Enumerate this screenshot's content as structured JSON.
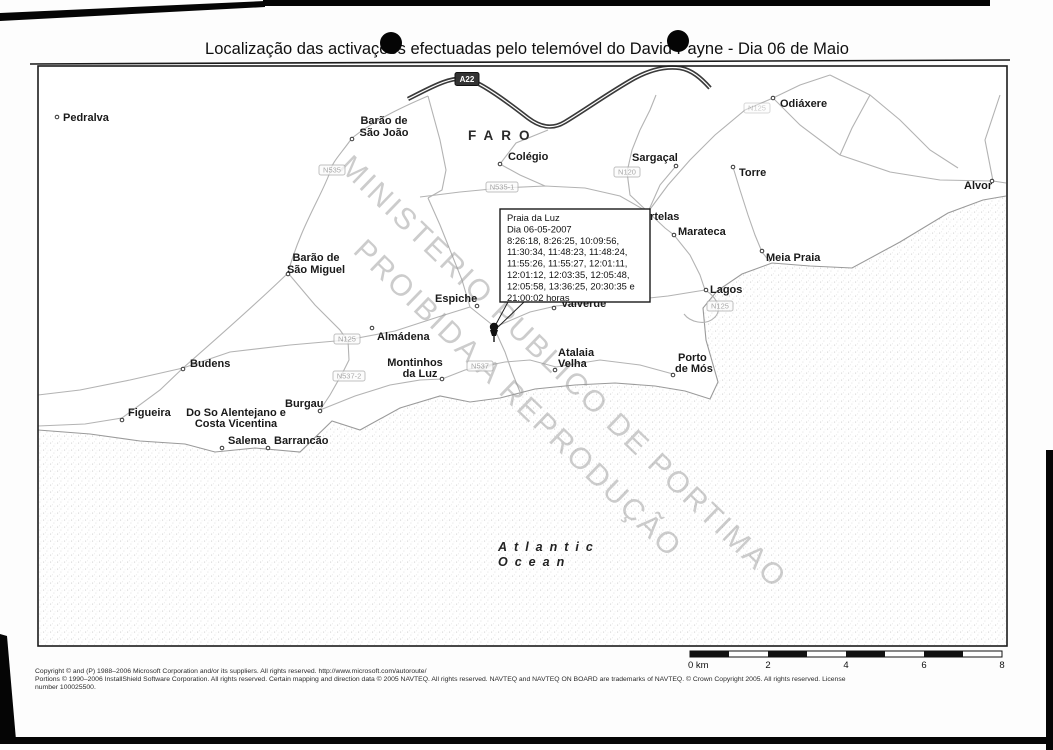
{
  "title": "Localização das activações efectuadas pelo telemóvel do David Payne - Dia 06 de Maio",
  "watermark": {
    "line1": "MINISTERIO PUBLICO DE PORTIMAO",
    "line2": "PROIBIDA A REPRODUÇÃO"
  },
  "map": {
    "district_label": "FARO",
    "ocean_label": {
      "line1": "Atlantic",
      "line2": "Ocean"
    },
    "callout": {
      "lines": [
        "Praia da Luz",
        "Dia 06-05-2007",
        "8:26:18, 8:26:25, 10:09:56,",
        "11:30:34, 11:48:23, 11:48:24,",
        "11:55:26, 11:55:27, 12:01:11,",
        "12:01:12, 12:03:35, 12:05:48,",
        "12:05:58, 13:36:25, 20:30:35 e",
        "21:00:02 horas"
      ]
    },
    "places": [
      {
        "name": "Pedralva"
      },
      {
        "name": "Barão de São João",
        "lines": [
          "Barão de",
          "São João"
        ]
      },
      {
        "name": "Colégio"
      },
      {
        "name": "Sargaçal"
      },
      {
        "name": "Odiáxere"
      },
      {
        "name": "Torre"
      },
      {
        "name": "Alvor"
      },
      {
        "name": "Portelas"
      },
      {
        "name": "Marateca"
      },
      {
        "name": "Meia Praia"
      },
      {
        "name": "Lagos"
      },
      {
        "name": "Barão de São Miguel",
        "lines": [
          "Barão de",
          "São Miguel"
        ]
      },
      {
        "name": "Espiche"
      },
      {
        "name": "Almádena"
      },
      {
        "name": "Montinhos da Luz",
        "lines": [
          "Montinhos",
          "da Luz"
        ]
      },
      {
        "name": "Valverde"
      },
      {
        "name": "Atalaia Velha",
        "lines": [
          "Atalaia",
          "Velha"
        ]
      },
      {
        "name": "Porto de Mós",
        "lines": [
          "Porto",
          "de Mós"
        ]
      },
      {
        "name": "Budens"
      },
      {
        "name": "Figueira"
      },
      {
        "name": "Do So Alentejano e Costa Vicentina",
        "lines": [
          "Do So Alentejano e",
          "Costa Vicentina"
        ]
      },
      {
        "name": "Salema"
      },
      {
        "name": "Barrancão"
      },
      {
        "name": "Burgau"
      }
    ],
    "road_shields": [
      {
        "label": "A22"
      },
      {
        "label": "N535"
      },
      {
        "label": "N535-1"
      },
      {
        "label": "N120"
      },
      {
        "label": "N125"
      },
      {
        "label": "N125"
      },
      {
        "label": "N125"
      },
      {
        "label": "N537"
      },
      {
        "label": "N537-2"
      }
    ]
  },
  "scale_bar": {
    "labels": [
      "0 km",
      "2",
      "4",
      "6",
      "8"
    ]
  },
  "copyright_lines": [
    "Copyright © and (P) 1988–2006 Microsoft Corporation and/or its suppliers. All rights reserved. http://www.microsoft.com/autoroute/",
    "Portions © 1990–2006 InstallShield Software Corporation. All rights reserved. Certain mapping and direction data © 2005 NAVTEQ. All rights reserved. NAVTEQ and NAVTEQ ON BOARD are trademarks of NAVTEQ. © Crown Copyright 2005. All rights reserved. License",
    "number 100025500."
  ],
  "colors": {
    "road": "#b3b3b3",
    "motorway": "#3a3a3a",
    "label": "#1a1a1a",
    "watermark": "#9a9a9a",
    "ocean_speckle": "#cfcfcf"
  }
}
